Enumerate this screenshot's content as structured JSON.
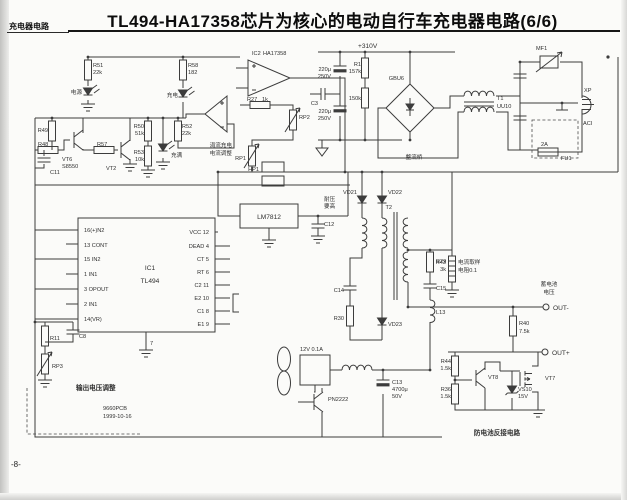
{
  "header": {
    "title": "TL494-HA17358芯片为核心的电动自行车充电器电路(6/6)",
    "corner": "充电器电路",
    "page": "-8-"
  },
  "colors": {
    "ink": "#3c3c3c",
    "paper": "#fbfbf9"
  },
  "ic1": {
    "ref": "IC1",
    "part": "TL494",
    "pins_left": [
      "16(+)N2",
      "13 CONT",
      "15 IN2",
      "1 IN1",
      "3 OPOUT",
      "2 IN1",
      "14(VR)"
    ],
    "pins_right": [
      "VCC 12",
      "DEAD 4",
      "CT 5",
      "RT 6",
      "C2 11",
      "E2 10",
      "C1 8",
      "E1 9"
    ],
    "pin_gnd": "7"
  },
  "labels": {
    "r51a": "R51",
    "r51b": "22k",
    "led_power": "电源",
    "r58a": "R58",
    "r58b": "182",
    "led_charge": "充电",
    "r49": "R49",
    "r48": "R48",
    "c11": "C11",
    "vt6a": "VT6",
    "vt6b": "S8550",
    "r57": "R57",
    "vt2": "VT2",
    "r50a": "R50",
    "r50b": "51k",
    "r53a": "R53",
    "r53b": "10k",
    "r52a": "R52",
    "r52b": "22k",
    "led_full": "充满",
    "ic2a": "IC2",
    "ic2b": "HA17358",
    "r27a": "R27",
    "r27b": "1k",
    "rp2": "RP2",
    "rp1": "RP1",
    "hp1": "HP1",
    "trickle1": "涓流充电",
    "trickle2": "电流调整",
    "v310": "+310V",
    "cap220a1": "220μ",
    "cap220a2": "250V",
    "c3": "C3",
    "cap220b1": "220μ",
    "cap220b2": "250V",
    "r1a": "R1",
    "r1b": "157k",
    "r2b": "150k",
    "bridge": "GBU6",
    "bridge_note": "整流桥",
    "t1a": "T1",
    "t1b": "UU10",
    "mf1": "MF1",
    "xp": "XP",
    "aci": "ACI",
    "fu1": "FU1",
    "fuse2a": "2A",
    "reg": "LM7812",
    "c12": "C12",
    "c12n1": "耐压",
    "c12n2": "要高",
    "vd21": "VD21",
    "vd22": "VD22",
    "vd23": "VD23",
    "t2": "T2",
    "c14": "C14",
    "r30": "R30",
    "r29": "R29",
    "c15": "C15",
    "l13": "L13",
    "r43a": "R43",
    "r43b": "3k",
    "sense1": "电流取样",
    "sense2": "电阻0.1",
    "batt1": "蓄电池",
    "batt2": "电压",
    "out_neg": "OUT-",
    "out_pos": "OUT+",
    "r40a": "R40",
    "r40b": "7.5k",
    "r44a": "R44",
    "r44b": "1.5k",
    "vt8": "VT8",
    "r36a": "R36",
    "r36b": "1.5k",
    "vs10a": "VS10",
    "vs10b": "15V",
    "vt7": "VT7",
    "revprot": "防电池反接电路",
    "fan": "12V 0.1A",
    "qfan": "PN2222",
    "c13a": "C13",
    "c13b": "4700μ",
    "c13c": "50V",
    "r11": "R11",
    "c8": "C8",
    "rp3": "RP3",
    "vadj": "输出电压调整",
    "pcb": "9660PCB",
    "pcbdate": "1999-10-16"
  }
}
